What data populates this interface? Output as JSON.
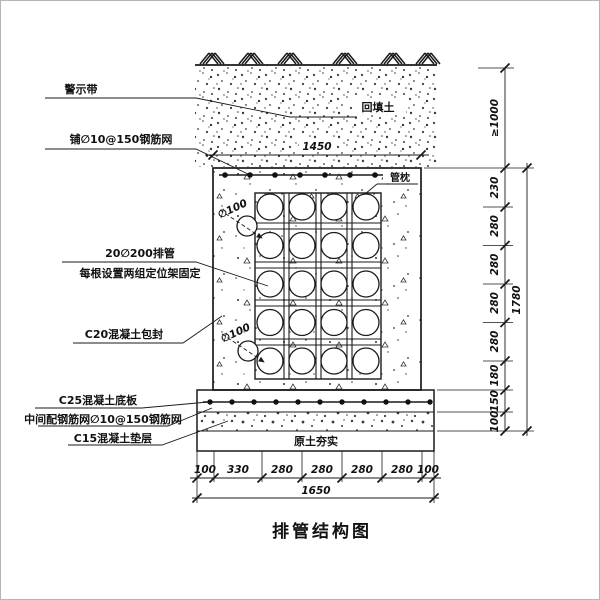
{
  "title": "排管结构图",
  "labels": {
    "warning_tape": "警示带",
    "mesh_top": "铺∅10@150钢筋网",
    "backfill": "回填土",
    "pipe_pillow": "管枕",
    "pipe_row_line1": "20∅200排管",
    "pipe_row_line2": "每根设置两组定位架固定",
    "encasement": "C20混凝土包封",
    "base_slab": "C25混凝土底板",
    "slab_mesh": "中间配钢筋网∅10@150钢筋网",
    "cushion": "C15混凝土垫层",
    "compacted_soil": "原土夯实",
    "drain_dia": "∅100"
  },
  "dims": {
    "width_top": "1450",
    "width_bottom_overall": "1650",
    "bottom_segments": [
      "100",
      "330",
      "280",
      "280",
      "280",
      "280",
      "100"
    ],
    "cover_depth": "≥1000",
    "right_segments": [
      "230",
      "280",
      "280",
      "280",
      "280",
      "180",
      "150",
      "100"
    ],
    "height_overall": "1780"
  },
  "structure": {
    "pipe_rows": 5,
    "pipe_cols": 4,
    "pipe_count": 20
  },
  "colors": {
    "line": "#1a1a1a",
    "background": "#ffffff"
  }
}
